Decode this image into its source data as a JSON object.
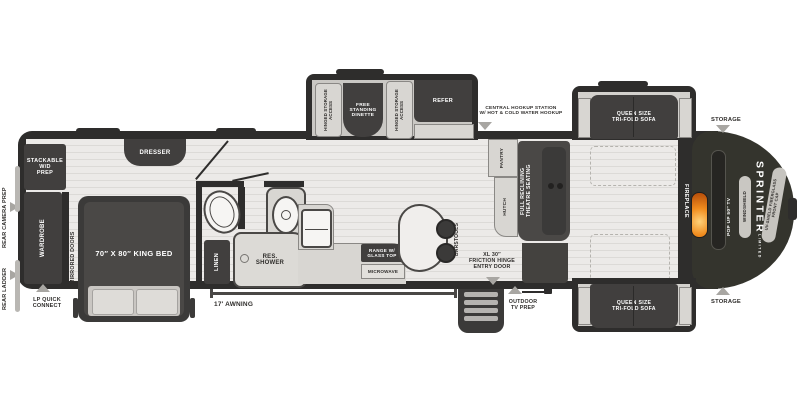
{
  "colors": {
    "wall": "#2e2d2c",
    "floor": "#eceae8",
    "floor_stripe": "#dcdad7",
    "dark_furniture": "#413f3e",
    "light_furniture": "#d8d6d2",
    "front_cap": "#34342d",
    "flame": "#f08c1e",
    "arrow": "#a8a6a2"
  },
  "callouts": {
    "rear_camera_prep": "REAR CAMERA PREP",
    "rear_ladder": "REAR LADDER",
    "lp_quick_connect": "LP QUICK\nCONNECT",
    "awning": "17′  AWNING",
    "outdoor_tv_prep": "OUTDOOR\nTV PREP",
    "central_hookup": "CENTRAL HOOKUP STATION\nW/ HOT & COLD WATER HOOKUP",
    "storage_top": "STORAGE",
    "storage_bottom": "STORAGE",
    "entry_door": "XL 30″\nFRICTION HINGE\nENTRY DOOR"
  },
  "bedroom": {
    "stackable_wd_prep": "STACKABLE\nW/D\nPREP",
    "wardrobe": "WARDROBE",
    "mirrored_doors": "MIRRORED DOORS",
    "king_bed": "70″ X 80″ KING BED",
    "dresser": "DRESSER"
  },
  "bathroom": {
    "linen": "LINEN",
    "shower": "RES.\nSHOWER"
  },
  "kitchen": {
    "range": "RANGE W/\nGLASS TOP",
    "microwave": "MICROWAVE",
    "barstools": "BARSTOOLS"
  },
  "dinette_slide": {
    "hinged_storage_left": "HINGED STORAGE\nACCESS",
    "dinette": "FREE\nSTANDING\nDINETTE",
    "hinged_storage_right": "HINGED STORAGE\nACCESS",
    "refer": "REFER"
  },
  "living": {
    "pantry": "PANTRY",
    "hutch": "HUTCH",
    "theatre": "FULL RECLINING\nTHEATRE SEATING",
    "sofa_top": "QUEEN SIZE\nTRI-FOLD SOFA",
    "sofa_bottom": "QUEEN SIZE\nTRI-FOLD SOFA",
    "fireplace": "FIREPLACE"
  },
  "front_cap": {
    "tv": "POP UP 50″ TV",
    "windshield": "WINDSHIELD",
    "brand": "SPRINTER",
    "brand_sub": "LIMITED",
    "cap_label": "UV-SHIELD FIBERGLASS\nFRONT CAP"
  }
}
